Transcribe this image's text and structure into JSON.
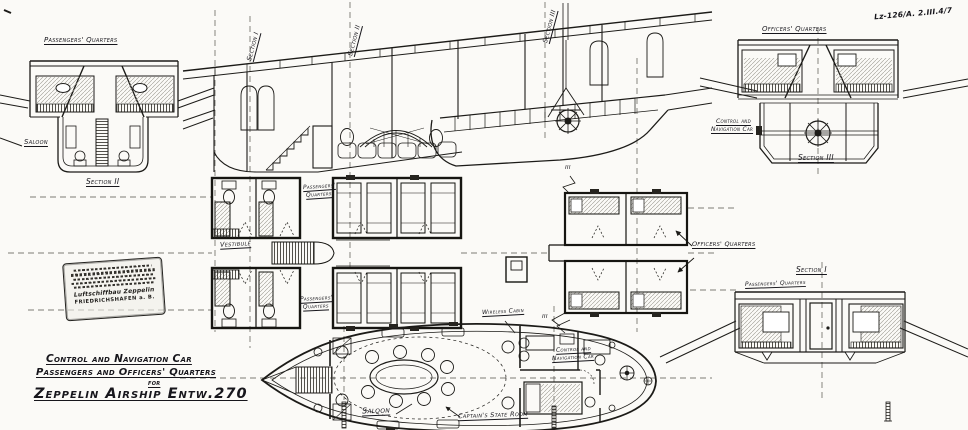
{
  "sheet": {
    "drawing_number": "Lz-126/A. 2.III.4/7",
    "title_block": {
      "line1": "Control and Navigation Car",
      "line2": "Passengers and Officers' Quarters",
      "line3": "for",
      "line4": "Zeppelin Airship Entw.270"
    },
    "stamp": {
      "company": "Luftschiffbau Zeppelin",
      "place": "FRIEDRICHSHAFEN a. B."
    }
  },
  "labels": {
    "tl_quarters": "Passengers' Quarters",
    "tl_saloon": "Saloon",
    "tl_section": "Section II",
    "marker_section_1": "Section I",
    "marker_section_2": "Section II",
    "marker_section_3": "Section III",
    "tr_quarters": "Officers' Quarters",
    "tr_car_1": "Control and",
    "tr_car_2": "Navigation Car",
    "tr_section": "Section III",
    "plan_pq1_1": "Passengers'",
    "plan_pq1_2": "Quarters",
    "plan_vestibule": "Vestibule",
    "plan_pq2_1": "Passengers'",
    "plan_pq2_2": "Quarters",
    "plan_officers": "Officers' Quarters",
    "marker_iii_top": "III",
    "marker_iii_bottom": "III",
    "br_section": "Section I",
    "br_quarters": "Passengers' Quarters",
    "g_wireless": "Wireless Cabin",
    "g_car_1": "Control and",
    "g_car_2": "Navigation Car",
    "g_saloon": "Saloon",
    "g_captain": "Captain's State Room"
  }
}
